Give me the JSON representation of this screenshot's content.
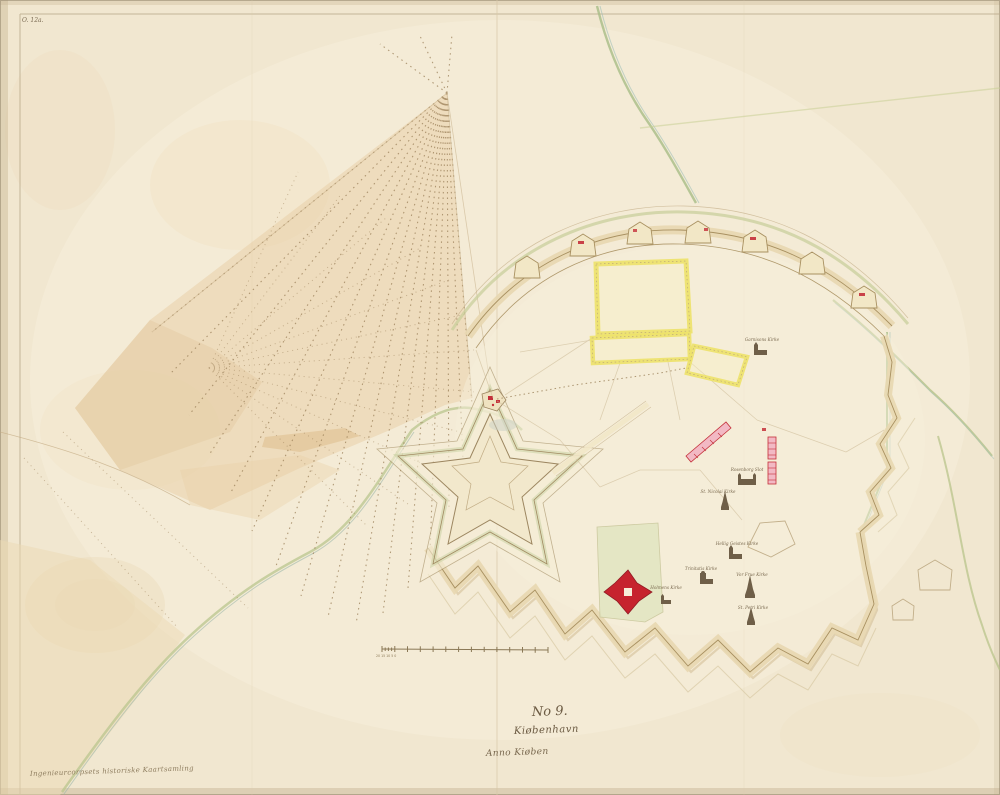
{
  "archive_mark": "O. 12a.",
  "collection_stamp": "Ingenieurcorpsets historiske Kaartsamling",
  "title_block": {
    "number": "No 9.",
    "title": "Kiøbenhavn",
    "inscription": "Anno Kiøben"
  },
  "scale_bar": {
    "sub_labels": "20 15 10 5 0"
  },
  "churches": [
    {
      "name": "Garnisons Kirke"
    },
    {
      "name": "Rosenborg Slot"
    },
    {
      "name": "St. Nicolai Kirke"
    },
    {
      "name": "Hellig Geistes Kirke"
    },
    {
      "name": "Trinitatis Kirke"
    },
    {
      "name": "Vor Frue Kirke"
    },
    {
      "name": "St. Petri Kirke"
    },
    {
      "name": "Holmens Kirke"
    }
  ],
  "palette": {
    "paper": "#f3ead4",
    "ink": "#8a7356",
    "glacis_green": "#c6cd99",
    "shore_green": "#b4c28c",
    "water_wash": "#e7cda4",
    "parcel_yellow": "#eee36a",
    "building_red": "#c4303a",
    "barracks_pink": "#f2b9c4"
  }
}
